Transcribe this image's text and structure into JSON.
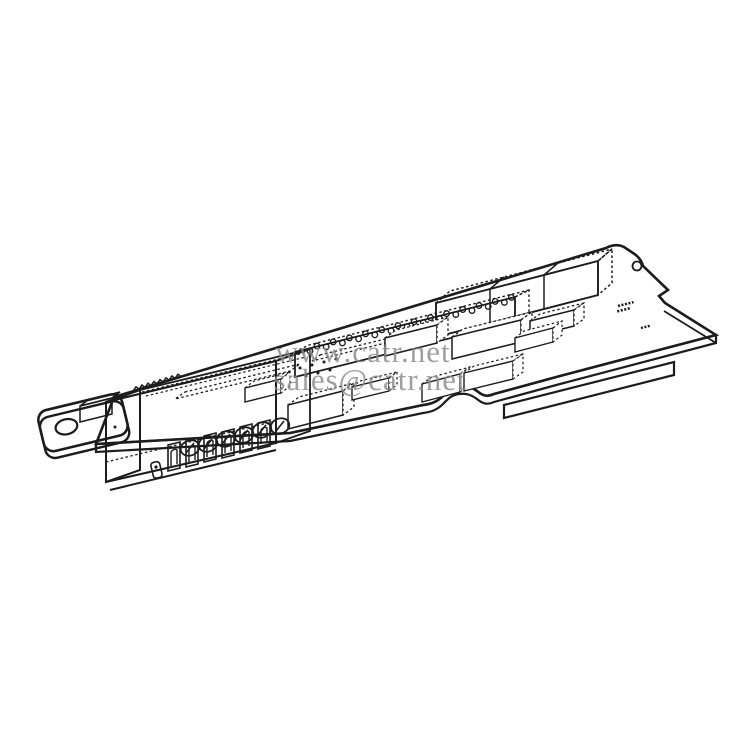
{
  "page": {
    "background_color": "#ffffff",
    "width_px": 750,
    "height_px": 750
  },
  "watermark": {
    "line1": "www.catr.net",
    "line2": "sales@catr.net",
    "color": "#8a8a8a"
  },
  "illustration": {
    "ink_color": "#1c1c1c",
    "subject": "isometric line drawing of a PCB option card with mounting tab, 6-screw terminal block, dual-row pin header and relay blocks",
    "board_markings": "illegible fine print"
  }
}
